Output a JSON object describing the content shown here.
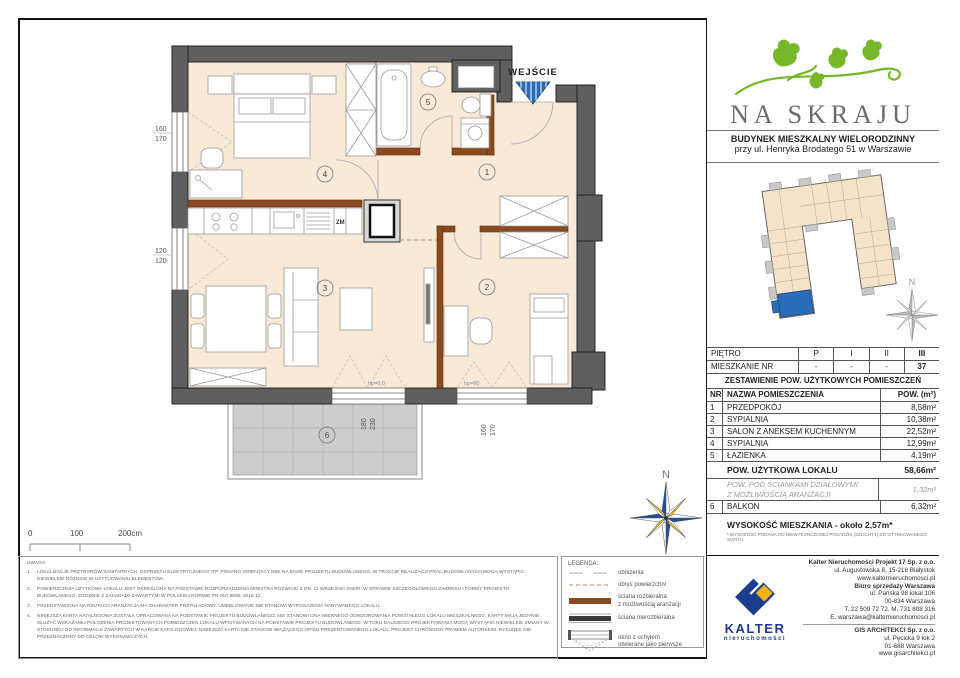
{
  "header": {
    "logo_title": "NA SKRAJU",
    "subtitle_line1": "BUDYNEK MIESZKALNY WIELORODZINNY",
    "subtitle_line2": "przy ul. Henryka Brodatego 51 w Warszawie"
  },
  "plan": {
    "entrance_label": "WEJŚCIE",
    "room_numbers": [
      "1",
      "2",
      "3",
      "4",
      "5",
      "6"
    ],
    "kitchen_zm": "ZM",
    "hp_door": "hp=0,0",
    "hp_window": "hp=60",
    "compass_n": "N",
    "dims": {
      "left_top": [
        "160",
        "170"
      ],
      "left_bottom": [
        "120",
        "120"
      ],
      "balcony": [
        "180",
        "230"
      ],
      "bottom_right": [
        "160",
        "170"
      ]
    },
    "scale_ticks": [
      "0",
      "100",
      "200cm"
    ]
  },
  "floor_table": {
    "row1_label": "PIĘTRO",
    "row1_values": [
      "P",
      "I",
      "II",
      "III"
    ],
    "row2_label": "MIESZKANIE NR",
    "row2_values": [
      "-",
      "-",
      "-",
      "37"
    ]
  },
  "area_table": {
    "title": "ZESTAWIENIE POW. UŻYTKOWYCH POMIESZCZEŃ",
    "col_nr": "NR",
    "col_name": "NAZWA POMIESZCZENIA",
    "col_area": "POW. (m²)",
    "rows": [
      {
        "nr": "1",
        "name": "PRZEDPOKÓJ",
        "area": "8,58m²"
      },
      {
        "nr": "2",
        "name": "SYPIALNIA",
        "area": "10,38m²"
      },
      {
        "nr": "3",
        "name": "SALON Z ANEKSEM KUCHENNYM",
        "area": "22,52m²"
      },
      {
        "nr": "4",
        "name": "SYPIALNIA",
        "area": "12,99m²"
      },
      {
        "nr": "5",
        "name": "ŁAZIENKA",
        "area": "4,19m²"
      }
    ],
    "total_label": "POW. UŻYTKOWA LOKALU",
    "total_value": "58,66m²",
    "partition_line1": "POW. POD ŚCIANKAMI DZIAŁOWYMI",
    "partition_line2": "Z MOŻLIWOŚCIĄ ARANŻACJI",
    "partition_value": "1,32m²",
    "balcony_nr": "6",
    "balcony_label": "BALKON",
    "balcony_value": "6,32m²",
    "height_label": "WYSOKOŚĆ MIESZKANIA - około 2,57m*",
    "height_footnote": "* WYSOKOŚĆ PODANA OD NIEWYKOŃCZONEJ POSADZKI (SZLICHTY) DO OTYNKOWANEGO SUFITU"
  },
  "notes": {
    "title": "UWAGA:",
    "items": [
      "LOKALIZACJE PRZYBORÓW SANITARNYCH, OSPRZĘTU ELEKTRYCZNEGO ITP. PODANO ORIENTACYJNIE NA BAZIE PROJEKTU BUDOWLANEGO. W TRAKCIE REALIZACJI PRAC BUDOWLANYCH MOGĄ WYSTĄPIĆ NIEWIELKIE RÓŻNICE W USYTUOWANIU ELEMENTÓW.",
      "POWIERZCHNIA UŻYTKOWA LOKALU JEST OKREŚLONA NA PODSTAWIE ROZPORZĄDZENIA MINISTRA ROZWOJU Z DN. 11 WRZEŚNIA 2020R. W SPRAWIE SZCZEGÓŁOWEGO ZAKRESU I FORMY PROJEKTU BUDOWLANEGO, ZGODNIE Z ZASADAMI ZAWARTYMI W POLSKIEJ NORMIE PN-ISO 9836: 2015-12.",
      "PRZEDSTAWIONA NA RZUTACH ARANŻACJA MA CHARAKTER PRZYKŁADOWY. UMEBLOWANIE NIE STANOWI WYPOSAŻENIA NABYWANEGO LOKALU.",
      "NINIEJSZA KARTA KATALOGOWA ZOSTAŁA OPRACOWANA NA PODSTAWIE PROJEKTU BUDOWLANEGO. NIE STANOWI ONA WIERNEGO ODWZOROWANIA POWSTAŁEGO LOKALU MIESZKALNEGO. KARTY MAJĄ JEDYNIE SŁUŻYĆ WSKAZANIU POŁOŻENIA PROJEKTOWANYCH POMIESZCZEŃ LOKALU WPISYWANYCH NA PODSTAWIE PROJEKTU BUDOWLANEGO. W TOKU DALSZEGO PROJEKTOWANIA MOGĄ WYSTĄPIĆ NIEWIELKIE ZMIANY W STOSUNKU DO INFORMACJI ZAWARTYCH W KARCIE KATALOGOWEJ. NINIEJSZA KARTA NIE STANOWI WIĄŻĄCEGO OPISU PREZENTOWANEGO LOKALU. PROJEKT CHRONIONY PRAWEM AUTORSKIM. RYSUNEK NIE PRZEZNACZONY DO CELÓW WYKONAWCZYCH."
    ]
  },
  "legend": {
    "title": "LEGENDA:",
    "items": [
      [
        "obniżenia"
      ],
      [
        "obrys powierzchni"
      ],
      [
        "ściana rozbieralna",
        "z możliwością aranżacji"
      ],
      [
        "ściana nierozbieralna"
      ],
      [
        "okno z uchyłem",
        "otwierane jako pierwsze"
      ]
    ]
  },
  "footer": {
    "kalter_word": "KALTER",
    "kalter_sub": "nieruchomości",
    "company1": {
      "name": "Kalter Nieruchomości Projekt 17 Sp. z o.o.",
      "lines": [
        "ul. Augustowska 8, 15-218 Białystok",
        "www.kalternieruchomosci.pl"
      ]
    },
    "company2": {
      "name": "Biuro sprzedaży Warszawa",
      "lines": [
        "ul. Pańska 98 lokal 106",
        "00-834 Warszawa",
        "T. 22 509 72 72. M. 731 808 316",
        "E. warszawa@kalternieruchomosci.pl"
      ]
    },
    "company3": {
      "name": "GIS ARCHITEKCI Sp. z o.o.",
      "lines": [
        "ul. Pęcicka 9 lok 2",
        "01-688 Warszawa",
        "www.gisarchitekci.pl"
      ]
    }
  },
  "colors": {
    "wall_gray": "#5f5f5f",
    "wall_brown": "#8a4a1f",
    "floor": "#f9e9d7",
    "balcony_tile": "#cdcdcd",
    "accent_blue": "#2b6cb8",
    "logo_green": "#76b82a",
    "kalter_navy": "#1b3d8f",
    "kalter_yellow": "#f0b412"
  }
}
